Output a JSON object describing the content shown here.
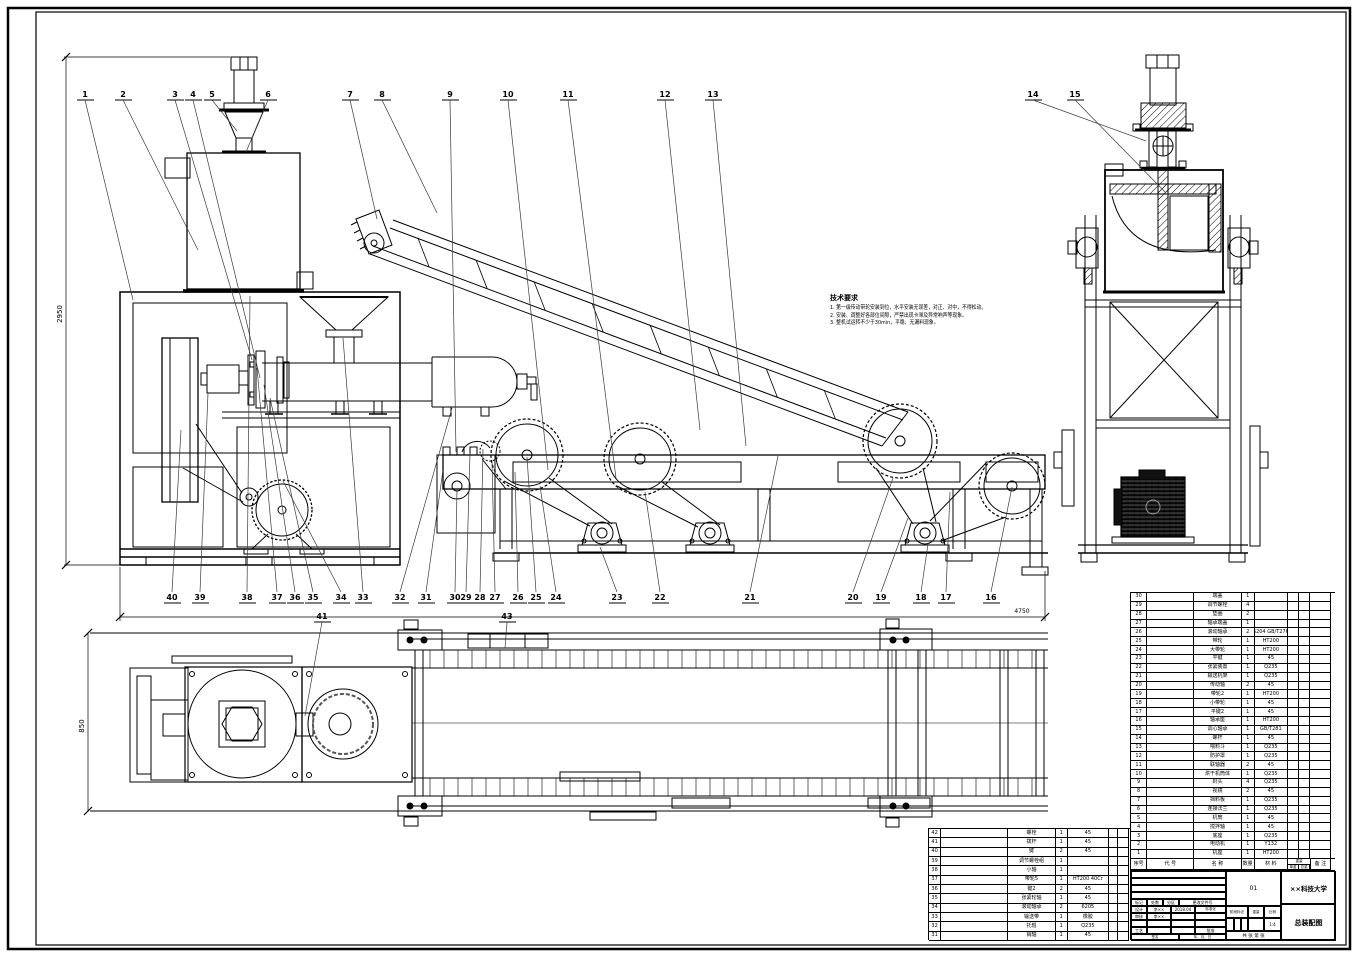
{
  "sheet": {
    "bg": "#ffffff",
    "line": "#000000",
    "leader": "#3a3a3a"
  },
  "notes": {
    "title": "技术要求",
    "lines": [
      "1. 第一级传动带轮安装到位，水平安装无误差，对正、对中，不得松动。",
      "2. 安装、调整好各部位间隙，严禁出现卡滞及异常响声等现象。",
      "3. 整机试运转不少于30min，平稳、无漏料现象。"
    ]
  },
  "dimensions": {
    "main_height": "2950",
    "main_length": "4750",
    "plan_width": "850"
  },
  "callouts": {
    "top": [
      "1",
      "2",
      "3",
      "4",
      "5",
      "6",
      "7",
      "8",
      "9",
      "10",
      "11",
      "12",
      "13",
      "14",
      "15"
    ],
    "bottom": [
      "40",
      "39",
      "38",
      "37",
      "36",
      "35",
      "34",
      "33",
      "32",
      "31",
      "30",
      "29",
      "28",
      "27",
      "26",
      "25",
      "24",
      "23",
      "22",
      "21",
      "20",
      "19",
      "18",
      "17",
      "16"
    ],
    "plan": [
      "41",
      "43"
    ]
  },
  "parts_list_right": {
    "header": {
      "no": "序号",
      "code": "代  号",
      "name": "名  称",
      "qty": "数量",
      "mat": "材  料",
      "weight_group": "重量",
      "unit": "单重",
      "total": "总重",
      "remark": "备 注"
    },
    "rows": [
      [
        "30",
        "",
        "端盖",
        "1",
        "",
        "",
        "",
        ""
      ],
      [
        "29",
        "",
        "调节螺栓",
        "4",
        "",
        "",
        "",
        ""
      ],
      [
        "28",
        "",
        "垫圈",
        "2",
        "",
        "",
        "",
        ""
      ],
      [
        "27",
        "",
        "轴承端盖",
        "1",
        "",
        "",
        "",
        ""
      ],
      [
        "26",
        "",
        "滚动轴承",
        "2",
        "6204 GB/T276",
        "",
        "",
        ""
      ],
      [
        "25",
        "",
        "带轮",
        "1",
        "HT200",
        "",
        "",
        ""
      ],
      [
        "24",
        "",
        "大带轮",
        "1",
        "HT200",
        "",
        "",
        ""
      ],
      [
        "23",
        "",
        "平键",
        "1",
        "45",
        "",
        "",
        ""
      ],
      [
        "22",
        "",
        "张紧装置",
        "1",
        "Q235",
        "",
        "",
        ""
      ],
      [
        "21",
        "",
        "输送机架",
        "1",
        "Q235",
        "",
        "",
        ""
      ],
      [
        "20",
        "",
        "传动轴",
        "2",
        "45",
        "",
        "",
        ""
      ],
      [
        "19",
        "",
        "带轮2",
        "1",
        "HT200",
        "",
        "",
        ""
      ],
      [
        "18",
        "",
        "小带轮",
        "1",
        "45",
        "",
        "",
        ""
      ],
      [
        "17",
        "",
        "平键2",
        "1",
        "45",
        "",
        "",
        ""
      ],
      [
        "16",
        "",
        "轴承座",
        "1",
        "HT200",
        "",
        "",
        ""
      ],
      [
        "15",
        "",
        "调心轴承",
        "1",
        "GB/T281",
        "",
        "",
        ""
      ],
      [
        "14",
        "",
        "螺杆",
        "1",
        "45",
        "",
        "",
        ""
      ],
      [
        "13",
        "",
        "喂料斗",
        "1",
        "Q235",
        "",
        "",
        ""
      ],
      [
        "12",
        "",
        "防护罩",
        "1",
        "Q235",
        "",
        "",
        ""
      ],
      [
        "11",
        "",
        "联轴器",
        "2",
        "45",
        "",
        "",
        ""
      ],
      [
        "10",
        "",
        "烘干机筒体",
        "1",
        "Q235",
        "",
        "",
        ""
      ],
      [
        "9",
        "",
        "封头",
        "4",
        "Q235",
        "",
        "",
        ""
      ],
      [
        "8",
        "",
        "视镜",
        "2",
        "45",
        "",
        "",
        ""
      ],
      [
        "7",
        "",
        "挡料板",
        "1",
        "Q235",
        "",
        "",
        ""
      ],
      [
        "6",
        "",
        "连接法兰",
        "1",
        "Q235",
        "",
        "",
        ""
      ],
      [
        "5",
        "",
        "机筒",
        "1",
        "45",
        "",
        "",
        ""
      ],
      [
        "4",
        "",
        "搅拌轴",
        "1",
        "45",
        "",
        "",
        ""
      ],
      [
        "3",
        "",
        "底座",
        "1",
        "Q235",
        "",
        "",
        ""
      ],
      [
        "2",
        "",
        "电动机",
        "1",
        "Y132",
        "",
        "",
        ""
      ],
      [
        "1",
        "",
        "机座",
        "1",
        "HT200",
        "",
        "",
        ""
      ]
    ]
  },
  "parts_list_left": {
    "rows": [
      [
        "42",
        "",
        "螺栓",
        "1",
        "45",
        "",
        ""
      ],
      [
        "41",
        "",
        "拨杆",
        "1",
        "45",
        "",
        ""
      ],
      [
        "40",
        "",
        "键",
        "2",
        "45",
        "",
        ""
      ],
      [
        "39",
        "",
        "调节螺栓组",
        "1",
        "",
        "",
        ""
      ],
      [
        "38",
        "",
        "小轴",
        "1",
        "",
        "",
        ""
      ],
      [
        "37",
        "",
        "带轮5",
        "1",
        "HT200 40Cr",
        "",
        ""
      ],
      [
        "36",
        "",
        "键2",
        "2",
        "45",
        "",
        ""
      ],
      [
        "35",
        "",
        "张紧轮轴",
        "1",
        "45",
        "",
        ""
      ],
      [
        "34",
        "",
        "滚动轴承",
        "2",
        "6205",
        "",
        ""
      ],
      [
        "33",
        "",
        "输送带",
        "1",
        "橡胶",
        "",
        ""
      ],
      [
        "32",
        "",
        "托辊",
        "1",
        "Q235",
        "",
        ""
      ],
      [
        "31",
        "",
        "销轴",
        "1",
        "45",
        "",
        ""
      ]
    ]
  },
  "title_block": {
    "rev_mark": "标记",
    "rev_count": "处数",
    "rev_zone": "分区",
    "rev_doc": "更改文件号",
    "sign": "签名",
    "date": "年、月、日",
    "design_label": "设计",
    "design_name": "李××",
    "design_date": "2018.04",
    "standard_label": "标准化",
    "check_label": "审核",
    "check_name": "李××",
    "process_label": "工艺",
    "approve_label": "批准",
    "stage_label": "阶段标记",
    "weight_label": "重量",
    "scale_label": "比例",
    "scale_value": "1:4",
    "sheet_label": "共 张 第 张",
    "drawing_code": "01",
    "org": "××科技大学",
    "title": "总装配图"
  }
}
